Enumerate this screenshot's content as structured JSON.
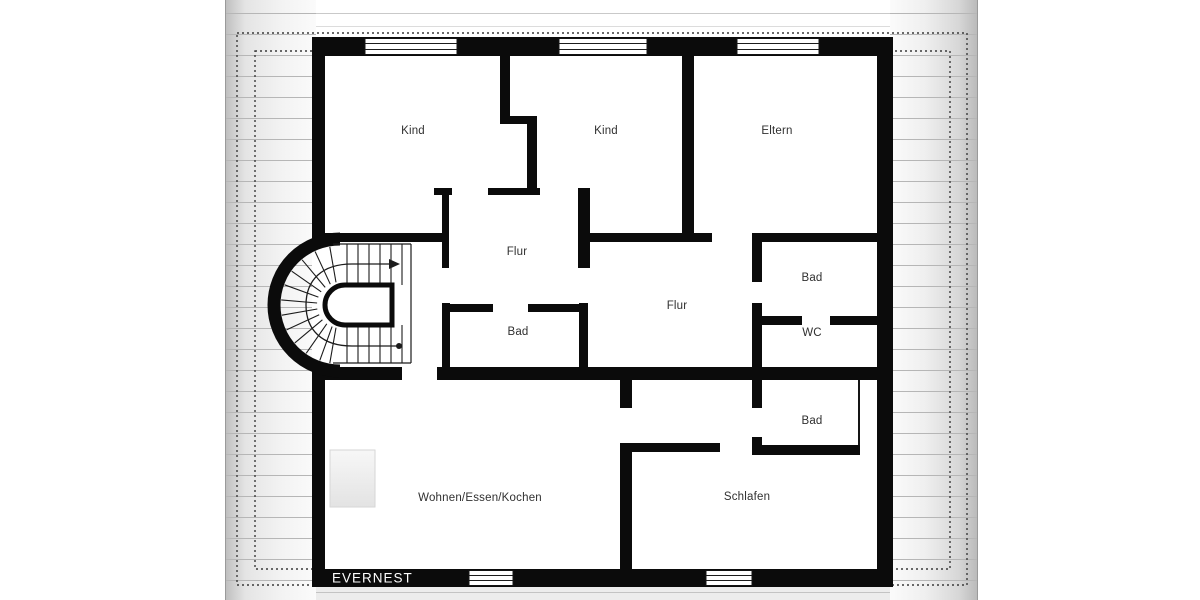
{
  "meta": {
    "type": "floor-plan",
    "floor": "upper-floor"
  },
  "brand": {
    "label": "EVERNEST"
  },
  "rooms": {
    "kind1": {
      "label": "Kind"
    },
    "kind2": {
      "label": "Kind"
    },
    "eltern": {
      "label": "Eltern"
    },
    "flur1": {
      "label": "Flur"
    },
    "flur2": {
      "label": "Flur"
    },
    "bad_mid": {
      "label": "Bad"
    },
    "bad_top": {
      "label": "Bad"
    },
    "wc": {
      "label": "WC"
    },
    "bad_bottom": {
      "label": "Bad"
    },
    "wohnen": {
      "label": "Wohnen/Essen/Kochen"
    },
    "schlafen": {
      "label": "Schlafen"
    }
  },
  "colors": {
    "wall": "#0b0b0b",
    "room_label_text": "#303030",
    "brand_text": "#ffffff",
    "roof_line": "#b6b6b6",
    "dashed_line": "#3a3a3a"
  }
}
